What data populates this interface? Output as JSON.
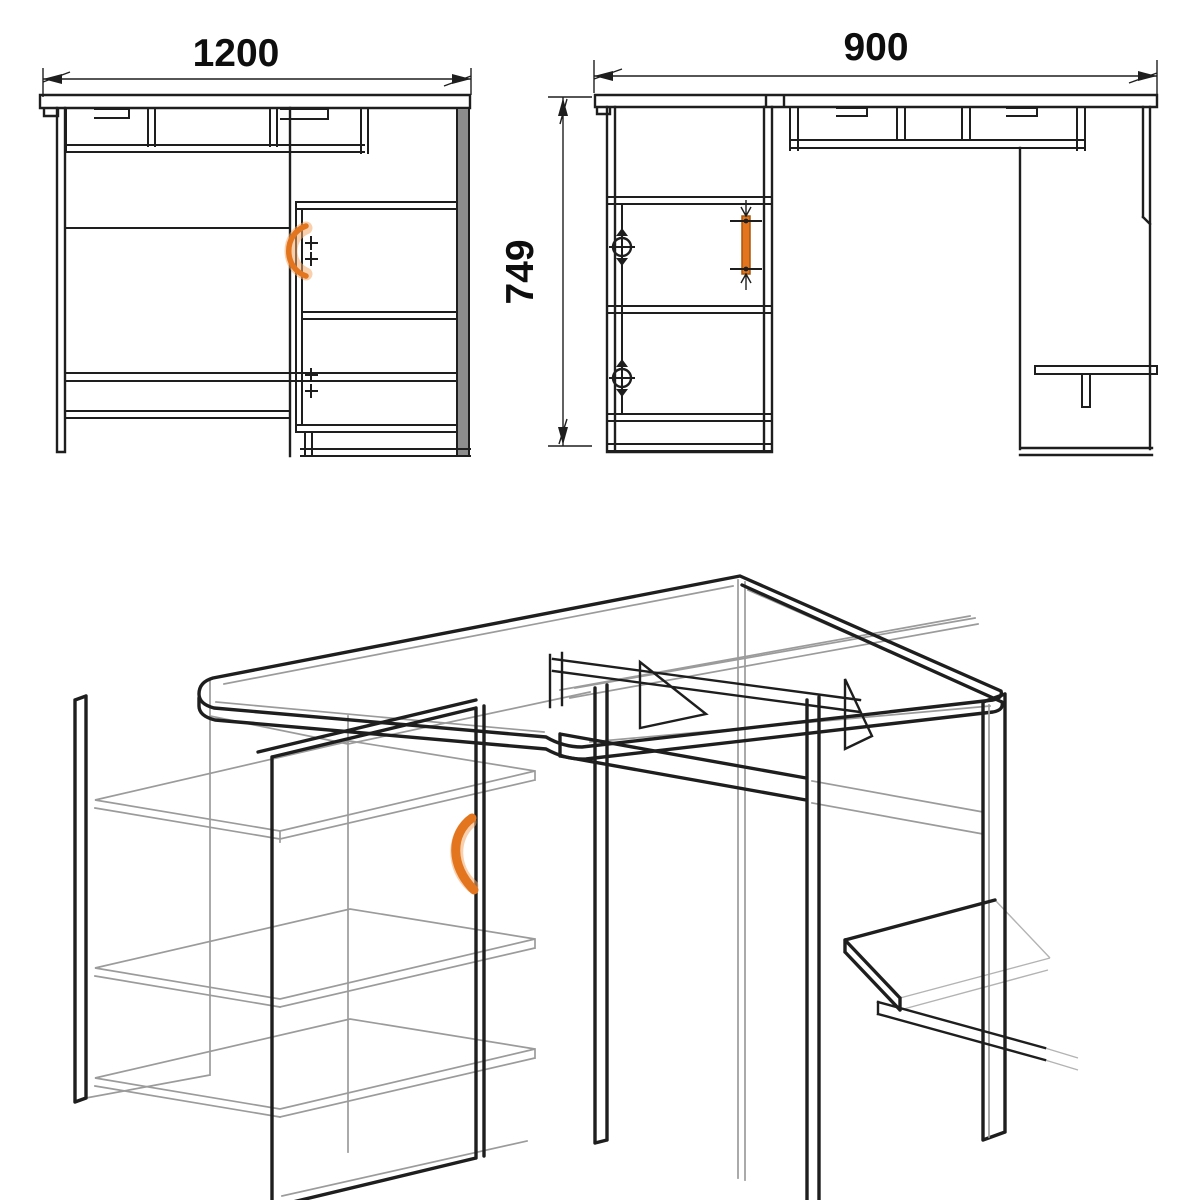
{
  "drawing": {
    "background": "#ffffff",
    "colors": {
      "line": "#1e1e1e",
      "hidden_line": "#9b9b9b",
      "accent": "#e2751d"
    },
    "views": {
      "front": {
        "width_label": "1200"
      },
      "side": {
        "depth_label": "900",
        "height_label": "749"
      },
      "isometric": {}
    }
  }
}
